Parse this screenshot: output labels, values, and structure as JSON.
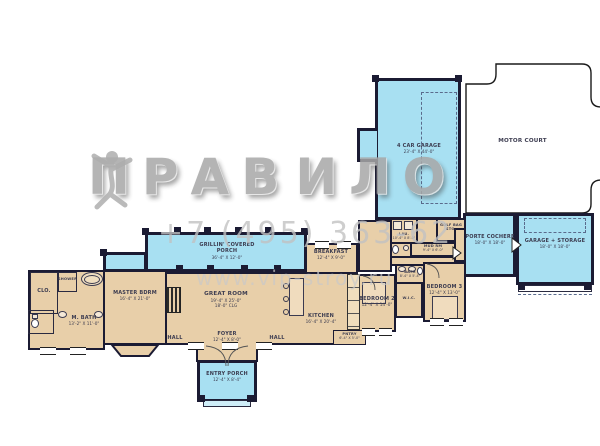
{
  "watermark": {
    "brand_left": "ПРАВ",
    "brand_right": "ИЛО",
    "phone": "+7 (495) 363-62",
    "site": "www.vip-stroy.ru"
  },
  "colors": {
    "porch": "#a8e0f2",
    "room": "#e8cfa9",
    "wall": "#1b1b33",
    "label": "#3c3c50"
  },
  "plan": {
    "motor_court": {
      "name": "MOTOR COURT"
    },
    "garage": {
      "name": "4 CAR GARAGE",
      "dims": "23'-4\" X 44'-0\""
    },
    "porte_cochere": {
      "name": "PORTE COCHERE",
      "dims": "18'-0\" X 18'-0\""
    },
    "garage_storage": {
      "name": "GARAGE + STORAGE",
      "dims": "18'-0\" X 18'-0\""
    },
    "grilling_porch": {
      "name": "GRILLIN' COVERED PORCH",
      "dims": "36'-4\" X 12'-0\""
    },
    "great_room": {
      "name": "GREAT ROOM",
      "dims": "19'-4\" X 25'-0\"",
      "clg": "18'-0\" CLG"
    },
    "foyer": {
      "name": "FOYER",
      "dims": "12'-4\" X 8'-0\""
    },
    "hall_left": {
      "name": "HALL"
    },
    "hall_right": {
      "name": "HALL"
    },
    "entry_porch": {
      "name": "ENTRY PORCH",
      "dims": "12'-4\" X 8'-4\""
    },
    "master_bdrm": {
      "name": "MASTER BDRM",
      "dims": "16'-4\" X 21'-0\""
    },
    "m_bath": {
      "name": "M. BATH",
      "dims": "13'-2\" X 11'-0\""
    },
    "closet": {
      "name": "CLO."
    },
    "shower": {
      "name": "SHOWER"
    },
    "breakfast": {
      "name": "BREAKFAST",
      "dims": "12'-4\" X 9'-0\""
    },
    "kitchen": {
      "name": "KITCHEN",
      "dims": "16'-4\" X 20'-4\""
    },
    "pantry": {
      "name": "PNTRY",
      "dims": "6'-4\" X 5'-0\""
    },
    "bedroom2": {
      "name": "BEDROOM 2",
      "dims": "12'-4\" X 14'-0\""
    },
    "bedroom3": {
      "name": "BEDROOM 3",
      "dims": "12'-4\" X 13'-0\""
    },
    "bath2": {
      "name": "BATH",
      "dims": "8'-4\" X 5'-4\""
    },
    "wic": {
      "name": "W.I.C."
    },
    "laundry": {
      "name": "LAU.",
      "dims": "10'-4\" X 8'-0\""
    },
    "golf_bag": {
      "name": "GOLF BAG STO."
    },
    "mud_rm": {
      "name": "MUD RM",
      "dims": "9'-4\" X 6'-0\""
    }
  }
}
